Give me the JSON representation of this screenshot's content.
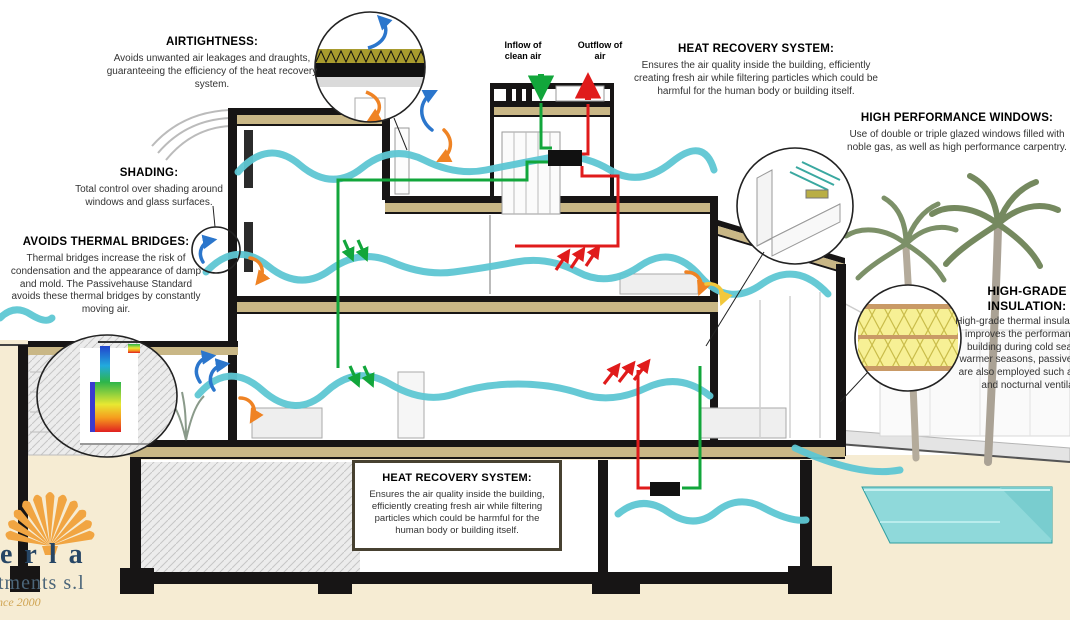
{
  "annotations": {
    "airtightness": {
      "title": "AIRTIGHTNESS:",
      "body": "Avoids unwanted air leakages and draughts, guaranteeing the efficiency of the heat recovery system."
    },
    "shading": {
      "title": "SHADING:",
      "body": "Total control over shading around windows and glass surfaces."
    },
    "thermal_bridges": {
      "title": "AVOIDS THERMAL BRIDGES:",
      "body": "Thermal bridges increase the risk of condensation and the appearance of damp and mold. The Passivehause Standard avoids these thermal bridges by constantly moving air."
    },
    "heat_recovery_top": {
      "title": "HEAT RECOVERY SYSTEM:",
      "body": "Ensures the air quality inside the building, efficiently creating fresh air while filtering particles which could be harmful for the human body or building itself."
    },
    "high_performance_windows": {
      "title": "HIGH PERFORMANCE WINDOWS:",
      "body": "Use of double or triple glazed windows filled with noble gas, as well as high performance carpentry."
    },
    "high_grade_insulation": {
      "title": "HIGH-GRADE INSULATION:",
      "body": "High-grade thermal insulation greatly improves the performance of the building during cold seasons. In warmer seasons, passive solutions are also employed such as shading and nocturnal ventilation."
    },
    "heat_recovery_bottom": {
      "title": "HEAT RECOVERY SYSTEM:",
      "body": "Ensures the air quality inside the building, efficiently creating fresh air while filtering particles which could be harmful for the human body or building itself."
    },
    "inflow_label": "Inflow of clean air",
    "outflow_label": "Outflow of air"
  },
  "logo": {
    "name_fragment": "erla",
    "subtitle_fragment": "tments s.l",
    "tagline_fragment": "nce 2000"
  },
  "icons": {
    "shell": "scallop-shell-logo",
    "inflow_arrow": "green-down-arrow",
    "outflow_arrow": "red-up-arrow"
  },
  "colors": {
    "ground_cream": "#f6ecd3",
    "insulation_tan": "#c9b786",
    "wall_black": "#171515",
    "airflow_teal": "#5ec7d3",
    "supply_green": "#12a63b",
    "exhaust_red": "#e01b1b",
    "cool_blue": "#2b76cc",
    "warm_orange": "#ef8324",
    "warm_yellow": "#f2c83c",
    "batt_yellow": "#f7f095",
    "pool_teal": "#8fd9da",
    "logo_navy": "#274665",
    "shell_orange": "#f1a542"
  }
}
